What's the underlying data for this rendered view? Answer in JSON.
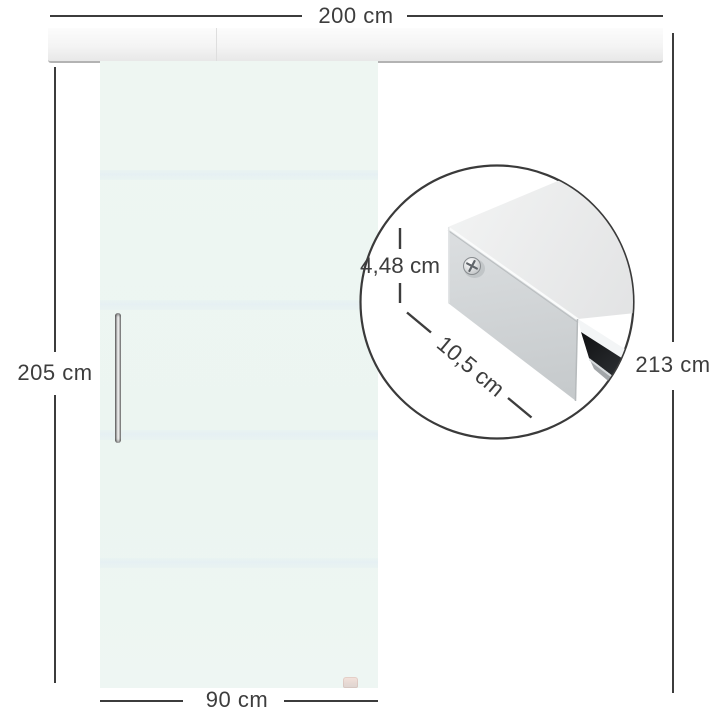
{
  "diagram": {
    "title_hint": "sliding-door-dimension-diagram",
    "labels": {
      "track_width": "200 cm",
      "door_height": "205 cm",
      "total_height": "213 cm",
      "door_width": "90 cm",
      "profile_height": "4,48 cm",
      "profile_depth": "10,5 cm"
    },
    "colors": {
      "background": "#ffffff",
      "dimension_line": "#3c3c3c",
      "label_text": "#3d3d3d",
      "rail_face": "#f4f4f4",
      "rail_bottom_edge": "#b3b3b3",
      "glass": "#edf5f1",
      "glass_stripe": "#e6f0f3",
      "handle_chrome": "#d9d9d9",
      "floor_guide": "#f0ddd6",
      "inset_outline": "#3a3a3a",
      "track_top_face": "#eaebeb",
      "track_front_face": "#d0d4d6",
      "track_slot": "#202326",
      "track_lip": "#a2a6a9"
    },
    "icons": {
      "screw": "phillips-screw-icon"
    }
  }
}
